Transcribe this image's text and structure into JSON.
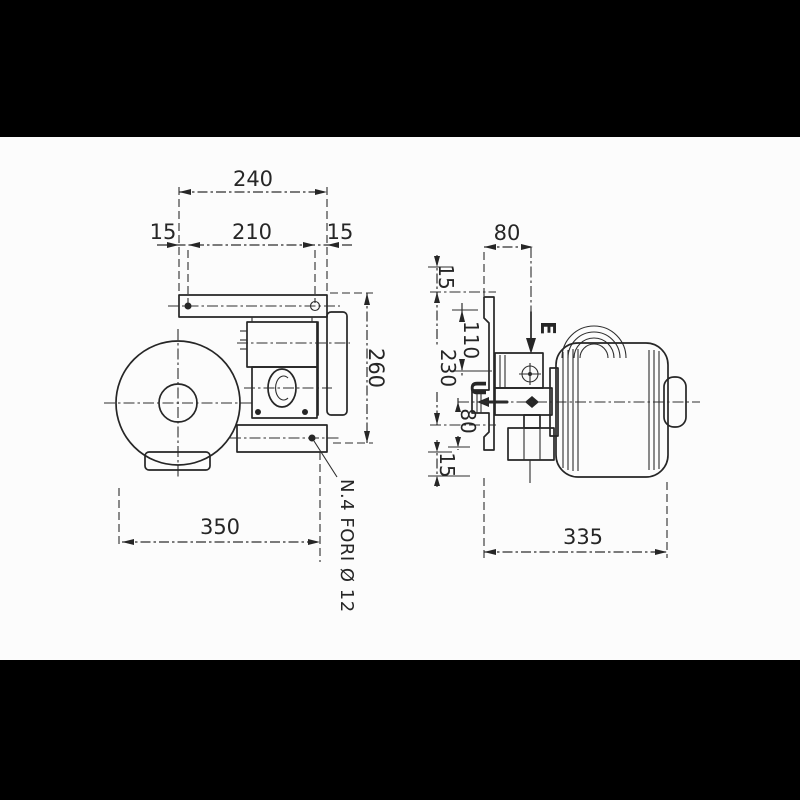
{
  "front_view": {
    "dims": {
      "plate_width": "240",
      "margin_left": "15",
      "hole_spacing": "210",
      "margin_right": "15",
      "plate_height": "260",
      "overall_width": "350"
    },
    "note_holes": "N.4 FORI Ø 12"
  },
  "side_view": {
    "dims": {
      "inlet_offset": "80",
      "margin_top": "15",
      "port_offset": "110",
      "hole_spacing": "230",
      "outlet_drop": "80",
      "margin_bottom": "15",
      "overall_length": "335"
    },
    "labels": {
      "inlet": "E",
      "outlet": "U"
    }
  },
  "colors": {
    "letterbox": "#000000",
    "paper": "#fcfcfc",
    "ink": "#262626"
  }
}
